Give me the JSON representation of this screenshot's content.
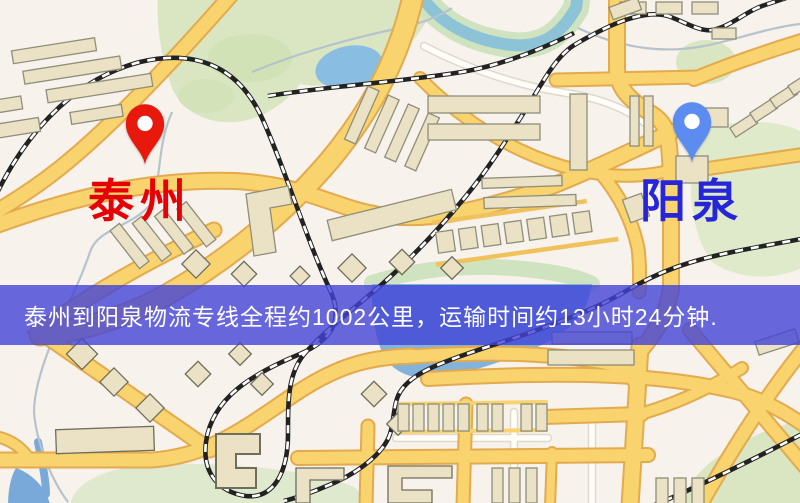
{
  "map": {
    "origin": {
      "label": "泰州",
      "pin_color": "#e8190c",
      "label_color": "#e60005"
    },
    "destination": {
      "label": "阳泉",
      "pin_color": "#5d8cf0",
      "label_color": "#2626d8"
    }
  },
  "banner": {
    "text": "泰州到阳泉物流专线全程约1002公里，运输时间约13小时24分钟.",
    "background_color": "#4244d7",
    "text_color": "#ffffff"
  },
  "route": {
    "origin": "泰州",
    "destination": "阳泉",
    "distance": "约1002公里",
    "duration": "约13小时24分钟"
  },
  "palette": {
    "map_background": "#f8f2ec",
    "road_yellow": "#f8d36e",
    "road_casing": "#e3aa4e",
    "water_blue": "#85b4db",
    "park_green": "#d9e6c1",
    "railway_black": "#222222",
    "building_beige": "#ebe2c6"
  }
}
